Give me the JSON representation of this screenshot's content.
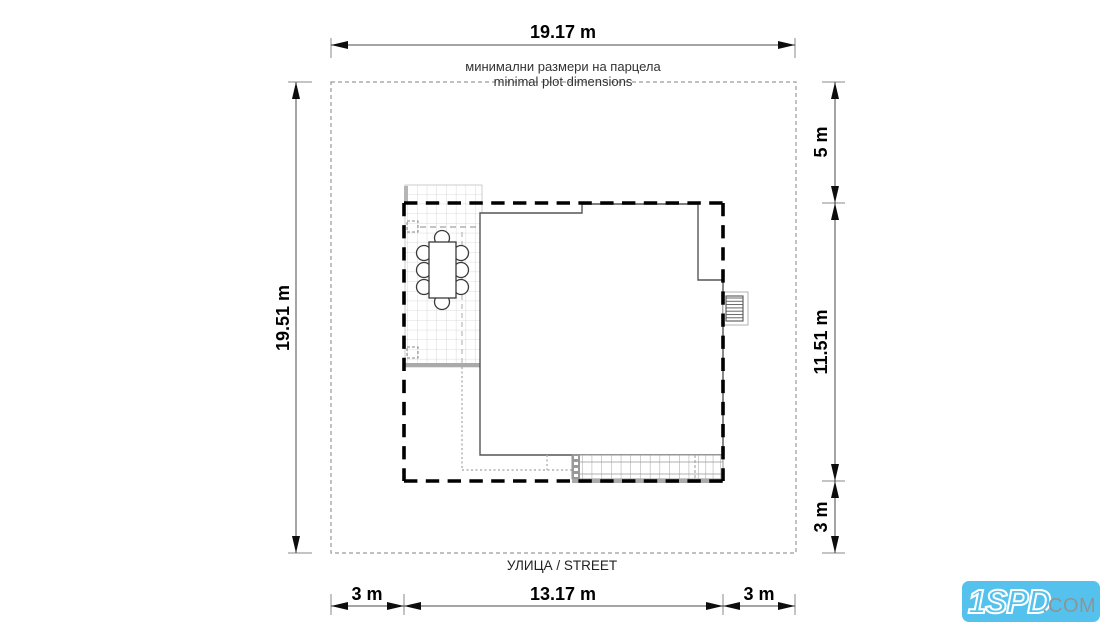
{
  "annotations": {
    "plot_note_bg": "минимални размери на парцела",
    "plot_note_en": "minimal plot dimensions",
    "street": "УЛИЦА / STREET"
  },
  "dimensions": {
    "plot_width": "19.17 m",
    "plot_height": "19.51 m",
    "setback_top": "5 m",
    "building_depth": "11.51 m",
    "setback_bottom": "3 m",
    "setback_left": "3 m",
    "building_width": "13.17 m",
    "setback_right": "3 m"
  },
  "logo": {
    "brand": "1SPD",
    "suffix": ".COM",
    "bg_color": "#55c2ee",
    "brand_color": "#ffffff",
    "suffix_color": "#8d9499"
  },
  "colors": {
    "building_envelope": "#000000",
    "plot_boundary": "#9a9a9a",
    "walls": "#555555",
    "tile_grid": "#cfcfcf"
  }
}
